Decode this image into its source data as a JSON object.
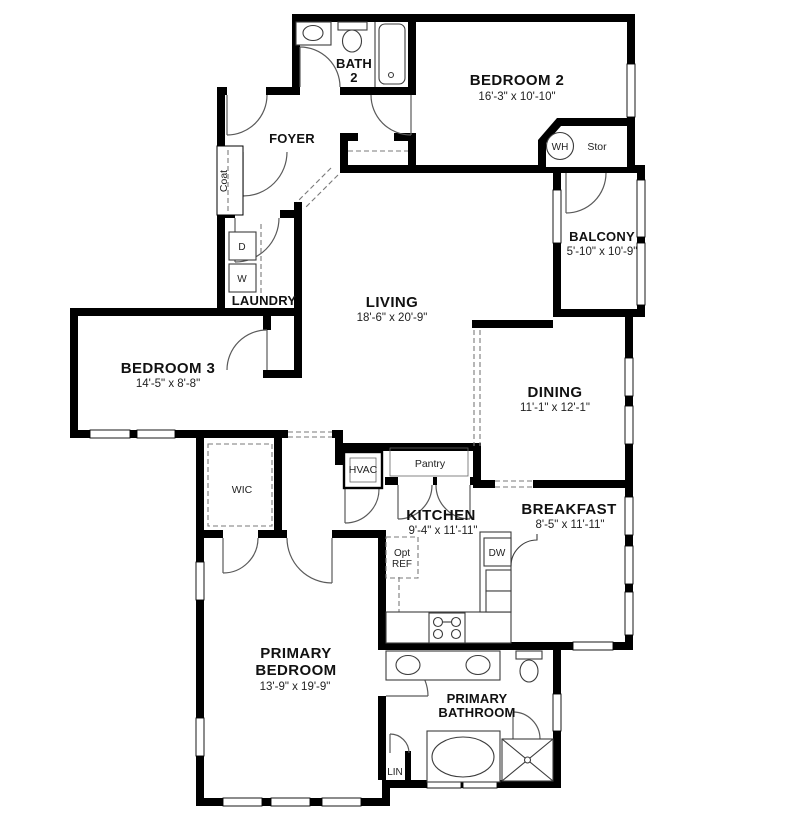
{
  "colors": {
    "wall": "#000000",
    "fixture_line": "#3c3c3c",
    "background": "#ffffff",
    "dashed_line": "#7a7a7a"
  },
  "rooms": {
    "bedroom2": {
      "name": "BEDROOM 2",
      "dims": "16'-3\" x 10'-10\""
    },
    "bath2": {
      "line1": "BATH",
      "line2": "2"
    },
    "foyer": {
      "name": "FOYER"
    },
    "balcony": {
      "name": "BALCONY",
      "dims": "5'-10\" x 10'-9\""
    },
    "living": {
      "name": "LIVING",
      "dims": "18'-6\" x 20'-9\""
    },
    "laundry": {
      "name": "LAUNDRY"
    },
    "bedroom3": {
      "name": "BEDROOM 3",
      "dims": "14'-5\" x 8'-8\""
    },
    "dining": {
      "name": "DINING",
      "dims": "11'-1\" x 12'-1\""
    },
    "kitchen": {
      "name": "KITCHEN",
      "dims": "9'-4\" x 11'-11\""
    },
    "breakfast": {
      "name": "BREAKFAST",
      "dims": "8'-5\" x 11'-11\""
    },
    "primary_bedroom": {
      "line1": "PRIMARY",
      "line2": "BEDROOM",
      "dims": "13'-9\" x 19'-9\""
    },
    "primary_bathroom": {
      "line1": "PRIMARY",
      "line2": "BATHROOM"
    },
    "wic": {
      "name": "WIC"
    },
    "hvac": {
      "name": "HVAC"
    },
    "pantry": {
      "name": "Pantry"
    },
    "coat": {
      "name": "Coat"
    },
    "stor": {
      "name": "Stor"
    },
    "water_heater": {
      "name": "WH"
    },
    "linen": {
      "name": "LIN"
    },
    "dryer": {
      "name": "D"
    },
    "washer": {
      "name": "W"
    },
    "dishwasher": {
      "name": "DW"
    },
    "opt_ref": {
      "line1": "Opt",
      "line2": "REF"
    }
  }
}
